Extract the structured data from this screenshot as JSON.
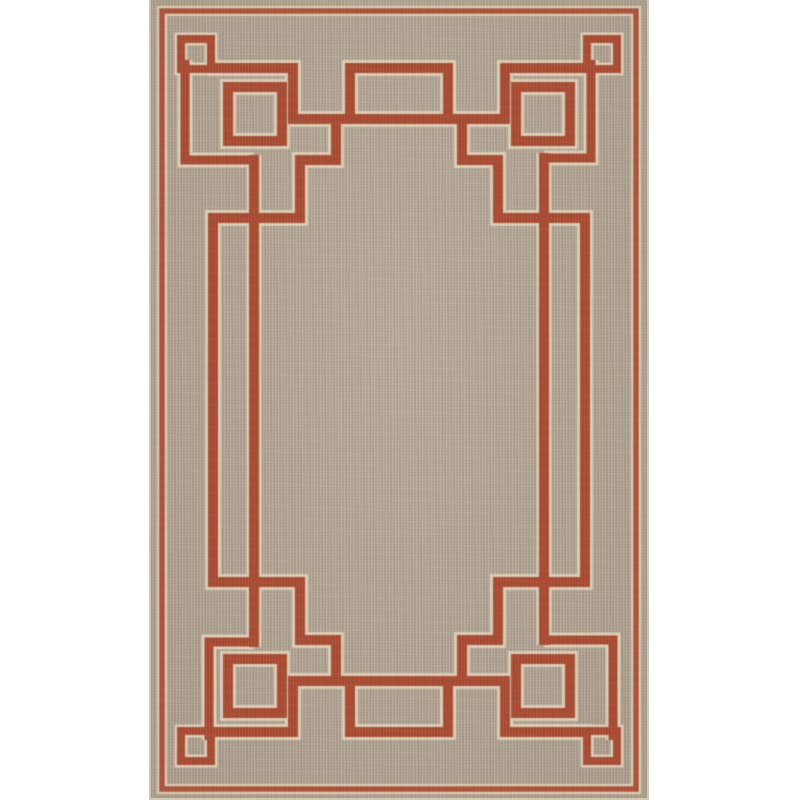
{
  "meta": {
    "alt_text": "Product photo: rectangular tan flat-weave area rug with a rust-red interlocking Greek-key square border pattern, shown upright on a plain white background"
  },
  "colors": {
    "bg": "#ffffff",
    "field": "#b3a593",
    "field_light": "#bfb2a0",
    "field_dark": "#a59782",
    "line": "#a84a31",
    "pinstripe": "#ac5038",
    "halo": "#d9cdb6",
    "edge": "#d2c7b4"
  },
  "rug": {
    "pattern_style": "interlocking Greek-key squares border",
    "shape": "rectangle-portrait",
    "motifs": [
      "outer thin pinstripe rectangle",
      "stepped key frame with long horizontal bands top and bottom",
      "open square at each outer corner",
      "nested open square inside each corner",
      "open box motif at top center and bottom center",
      "double vertical rails along left and right sides",
      "plain tan center field"
    ]
  }
}
